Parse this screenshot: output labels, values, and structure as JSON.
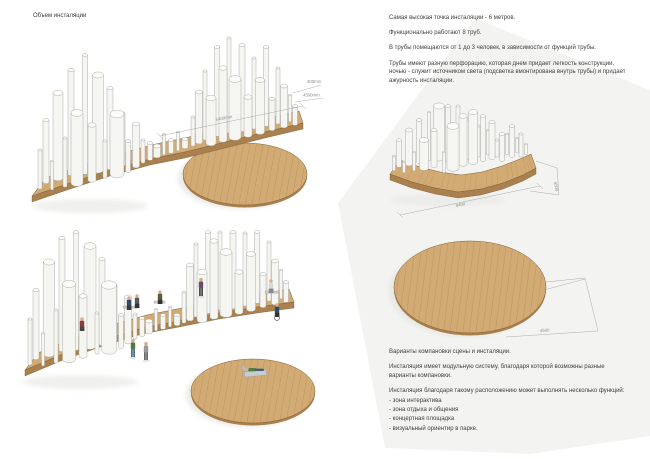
{
  "page": {
    "title": "Объем инсталяции"
  },
  "info_top": {
    "paragraphs": [
      "Самая высокая точка инсталяции - 6 метров.",
      "Функционально работают 8 труб.",
      "В трубы помещаются от 1 до 3 человек, в зависимости от функций трубы.",
      "Трубы имеют разную перфорацию, которая днем придает легкость конструкции, ночью - служит источником света (подсветка вмонтирована внутрь трубы) и придает ажурность инсталяции."
    ]
  },
  "info_bottom": {
    "heading": "Варианты компановки сцены и инсталяции.",
    "paragraph": "Инсталяция имеет модульную систему, благодаря которой возможны разные варианты компановки.",
    "functions_intro": "Инсталяция благодаря такому расположению может выполнять несколько функций:",
    "functions": [
      "- зона интерактива",
      "- зона отдыха и общения",
      "- концертная площадка",
      "- визуальный ориентир в парке."
    ]
  },
  "dimensions": {
    "view1": {
      "length": "5400mm",
      "thickness": "300mm",
      "depth": "4500mm"
    },
    "view3": {
      "length": "9400",
      "height": "4500",
      "circle_diameter": "4500"
    }
  },
  "colors": {
    "wood_top": "#d2aa74",
    "wood_edge": "#a9804e",
    "outline": "#7c6036",
    "plank": "#b78f5c",
    "tube": "#f5f5f2",
    "tube_top": "#fbfbf8",
    "tube_stroke": "#a6a6a2",
    "skin": "#d9ae8e",
    "dim": "#8c8c8c",
    "backdrop": "#f3f3f1"
  }
}
